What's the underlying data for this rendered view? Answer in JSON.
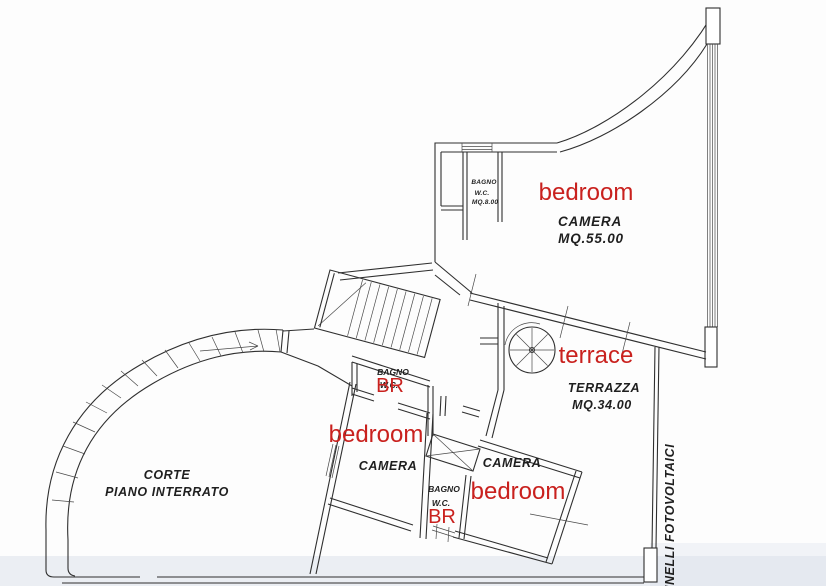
{
  "colors": {
    "annotation_red": "#c9211e",
    "ink": "#2f2f2f",
    "scan_band": "#d9e0ea"
  },
  "labels": {
    "bathroom_top": {
      "name": "BAGNO",
      "wc": "W.C.",
      "area": "MQ.8.00"
    },
    "bedroom_top": {
      "annotation": "bedroom",
      "room": "CAMERA",
      "area": "MQ.55.00"
    },
    "terrace": {
      "annotation": "terrace",
      "room": "TERRAZZA",
      "area": "MQ.34.00"
    },
    "bathroom_mid": {
      "name": "BAGNO",
      "wc": "W.C.",
      "annotation": "BR"
    },
    "bedroom_left": {
      "annotation": "bedroom",
      "room": "CAMERA"
    },
    "bedroom_right": {
      "annotation": "bedroom",
      "room": "CAMERA"
    },
    "bathroom_bottom": {
      "name": "BAGNO",
      "wc": "W.C.",
      "annotation": "BR"
    },
    "courtyard": {
      "line1": "CORTE",
      "line2": "PIANO INTERRATO"
    },
    "right_side": {
      "vertical_label": "PANNELLI FOTOVOLTAICI"
    }
  }
}
